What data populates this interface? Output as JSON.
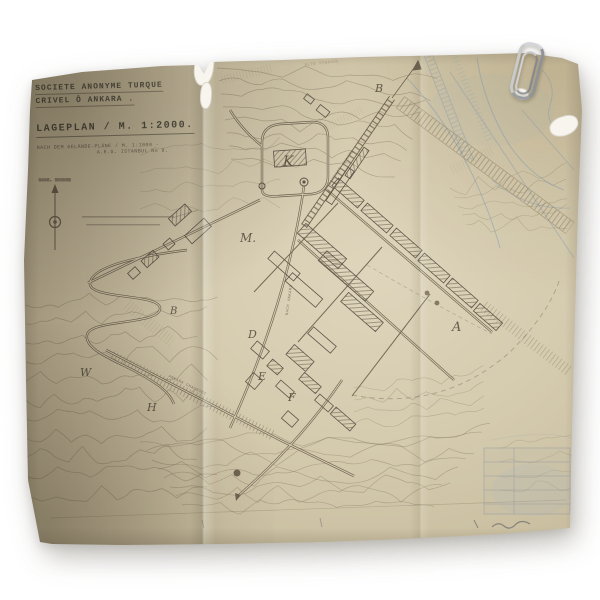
{
  "scene": {
    "description": "photograph of an aged, folded site-plan drawing fastened with a paper clip",
    "background_color": "#ffffff",
    "paper_color": "#d2c7aa",
    "ink_color": "#6d6351",
    "blue_ink_color": "#8fa3b8"
  },
  "title_block": {
    "company_line1": "SOCIETE ANONYME TURQUE",
    "company_line2": "CRIVEL Ô ANKARA .",
    "plan_line": "LAGEPLAN / M. 1:2000.",
    "source_line1": "NACH DEM GELÄNDE-PLÄNE / M. 1:1000 -",
    "source_line2": "A.E.G. ISTANBUL No 9."
  },
  "compass": {
    "label": "MAGN. NORDEN"
  },
  "map_labels": {
    "letters": {
      "k": "K",
      "m": "M.",
      "d": "D",
      "e": "E",
      "f": "F",
      "a": "A",
      "b_station": "B",
      "b_west": "B",
      "w": "W",
      "h": "H"
    },
    "roads": {
      "station": "BAHNHOF ANKARA",
      "old_road": "ALTE STRASSE",
      "chaussee": "ANKARA CHAUSSEE",
      "south": "NACH ANKARA"
    }
  }
}
